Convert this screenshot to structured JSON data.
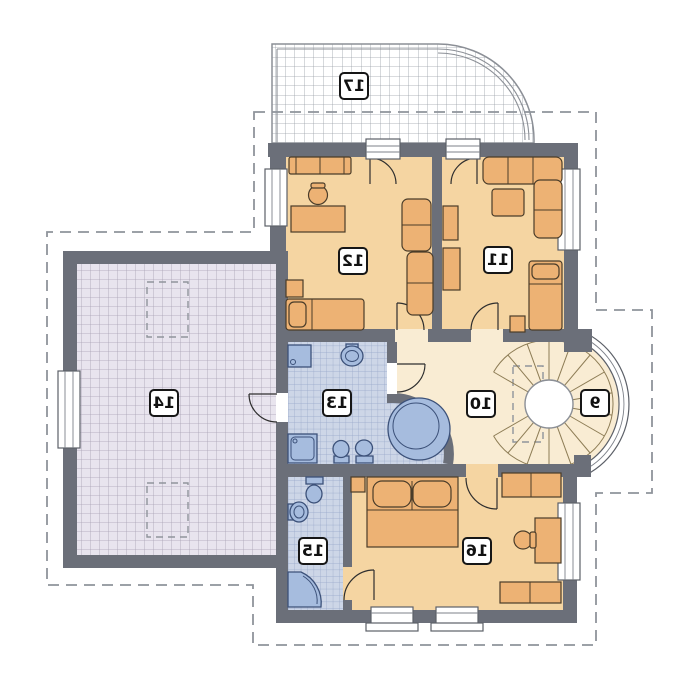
{
  "plan": {
    "type": "floor-plan",
    "orientation": "mirrored",
    "labels": [
      {
        "number": "9"
      },
      {
        "number": "10"
      },
      {
        "number": "11"
      },
      {
        "number": "12"
      },
      {
        "number": "13"
      },
      {
        "number": "14"
      },
      {
        "number": "15"
      },
      {
        "number": "16"
      },
      {
        "number": "17"
      }
    ]
  },
  "colors": {
    "wall": "#6b6f79",
    "room-warm": "#f5d5a2",
    "room-cream": "#f9ecd3",
    "furniture": "#edb274",
    "furniture-stroke": "#4a3c29",
    "bath-tile": "#cdd6e7",
    "bath-grid": "#97a6c9",
    "fixture": "#a6bcde",
    "fixture-stroke": "#3c5179",
    "attic-tile": "#e8e4ee",
    "attic-grid": "#a7a1b3",
    "terrace-grid": "#9aa0a8",
    "outline-dash": "#8f949b",
    "door-stroke": "#2e2e2e",
    "step-stroke": "#8d7c55",
    "label-border": "#161616"
  }
}
